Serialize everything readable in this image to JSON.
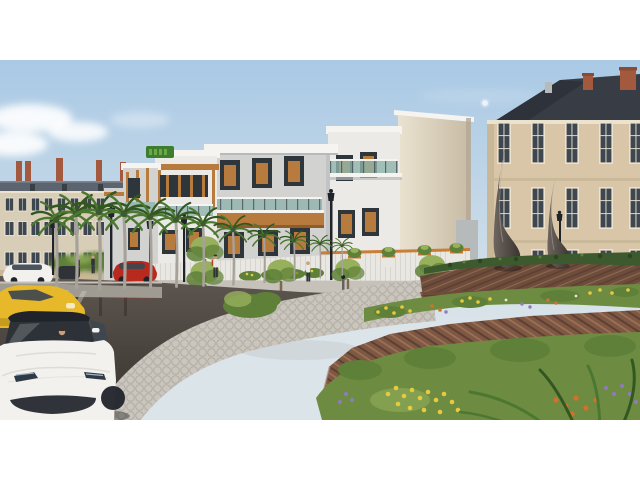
{
  "meta": {
    "type": "architectural-3d-render",
    "description": "Exterior visualization of a modern residential complex on a wet street corner with a landscaped brick-terraced roundabout, teardrop sculptures, palm trees, classical neighboring buildings and cars",
    "letterbox": {
      "bar_color": "#ffffff",
      "top_px": 60,
      "bottom_px": 60,
      "content_width": 640,
      "content_height": 360
    }
  },
  "scene": {
    "labels": {
      "frame": "rendered street scene",
      "sky": "pale blue morning sky",
      "moon": "small moon",
      "clouds": "soft clouds lower left",
      "leftBuilding": "classical beige building with grey mansard roof and chimneys",
      "rightBuilding": "classical stone building with dark slate roof and brick chimneys",
      "modernBuilding": "modern white apartment complex with amber wood accents and glass balconies",
      "rooftopSign": "illegible green rooftop logo sign",
      "compoundWall": "white slatted compound wall with orange trim and shrub planters",
      "street": "wet reflective asphalt street",
      "median": "grey median strip with crosswalk",
      "palms": "row of royal palm trees",
      "lamps": "black street lamps",
      "pedestrians": "pedestrians walking on sidewalk",
      "carTesla": "white sedan driving toward viewer with driver",
      "carYellow": "yellow hatchback",
      "carWhiteParked": "white parked sedan",
      "carRedSuv": "red SUV",
      "paverPath": "curved grey paver walkway with white curb",
      "roundabout": "terraced red-brick roundabout",
      "hedge": "trimmed hedge ring on upper terrace",
      "sculpture": "two dark bronze teardrop sculptures",
      "flowerBeds": "flower beds with yellow, orange and purple blooms"
    }
  },
  "palette": {
    "skyTop": "#a9c9e5",
    "skyHorizon": "#dbe4e9",
    "cloud": "#ffffff",
    "moon": "#eef3f7",
    "leftWall": "#d8cdb6",
    "leftRoof": "#5c646f",
    "chimney": "#a2593d",
    "rightWall": "#d9c6a8",
    "rightRoof": "#383d45",
    "quoin": "#c9b897",
    "windowDark": "#3e4750",
    "windowFrame": "#ece3cf",
    "modernWhite": "#eceae6",
    "modernGrey": "#d2d2d0",
    "modernShade": "#b7babb",
    "parapet": "#f5f4f1",
    "wood": "#b87b3e",
    "woodDark": "#8f5c2c",
    "frameDark": "#2e353b",
    "glass": "#8fb4ab",
    "railDark": "#46525a",
    "wallWhite": "#e9e7e2",
    "wallTrim": "#c8782e",
    "sidewalk": "#c6c2ba",
    "paver": "#cac6bd",
    "paverJoint": "#a19d94",
    "curb": "#edebe5",
    "median": "#a09b92",
    "roadTop": "#5e5750",
    "roadBottom": "#37322e",
    "roadShine": "#8a8178",
    "brick": "#7f5844",
    "brickDark": "#5d4033",
    "brickLight": "#9c7257",
    "brickFace": "#6d4c3b",
    "hedge": "#3c5a2d",
    "foliage": "#5e8038",
    "foliageLight": "#96b05c",
    "grass": "#6d8c41",
    "palmFrond": "#4c7730",
    "palmFrondDark": "#335720",
    "palmTrunk": "#a7a299",
    "flowerYellow": "#e9c93e",
    "flowerOrange": "#d4702a",
    "flowerPurple": "#8e7bbf",
    "flowerWhite": "#ece6d4",
    "carWhite": "#f2f1ee",
    "carYellow": "#e6b82a",
    "carRed": "#b92a1e",
    "sculptureLight": "#6e655f",
    "sculptureDark": "#3a3431",
    "lampBlack": "#20242a",
    "signGreen": "#3e7d2d",
    "skin": "#c99f82",
    "shirtWhite": "#e9e7e1",
    "backpackRed": "#c23a2a",
    "darkFigure": "#2f3338",
    "hair": "#3a2e26",
    "bollard": "#64605b",
    "creamLight": "#eae2d0",
    "creamDark": "#c7bba4"
  }
}
